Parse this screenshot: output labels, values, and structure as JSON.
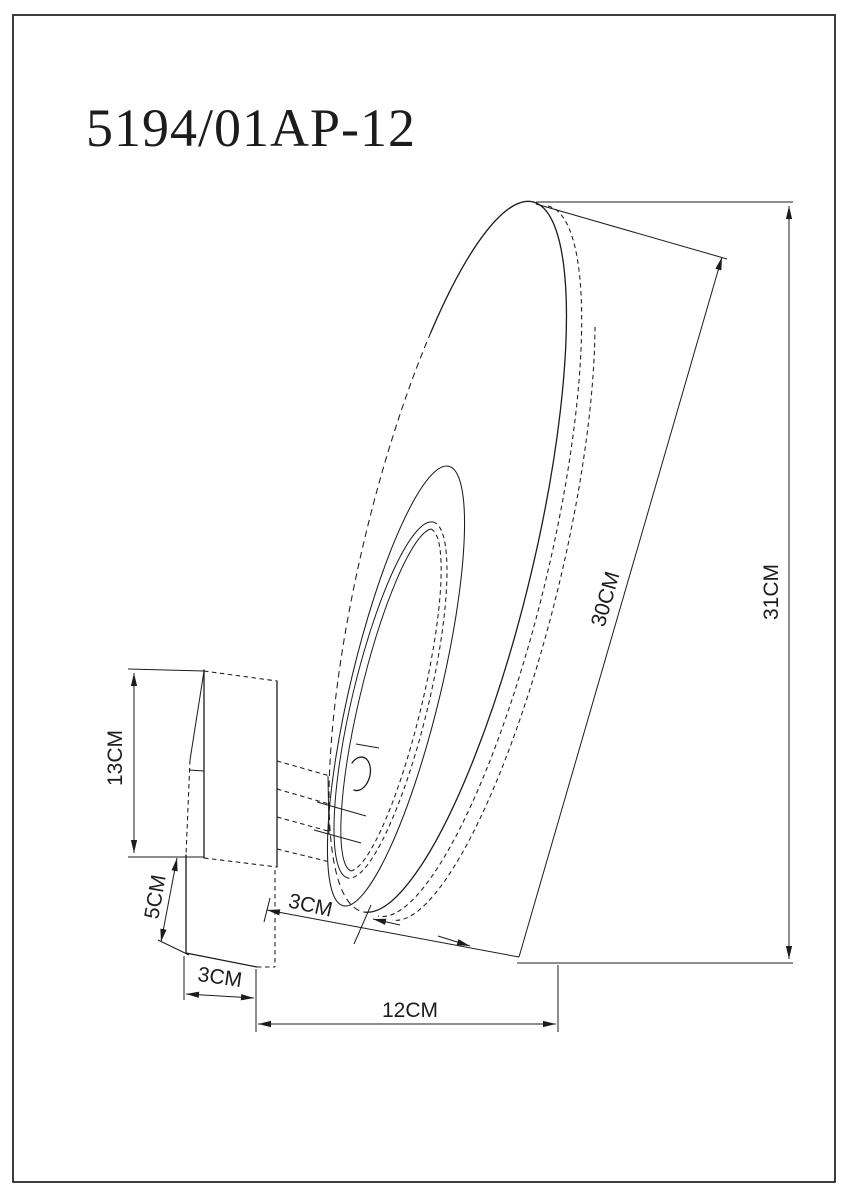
{
  "document": {
    "product_code": "5194/01AP-12",
    "background_color": "#ffffff",
    "line_color": "#1c1c1c"
  },
  "dimensions": {
    "shade_diameter": "30CM",
    "overall_height": "31CM",
    "backplate_height": "13CM",
    "backplate_lower_height": "5CM",
    "backplate_depth": "3CM",
    "arm_length": "3CM",
    "overall_depth": "12CM"
  }
}
